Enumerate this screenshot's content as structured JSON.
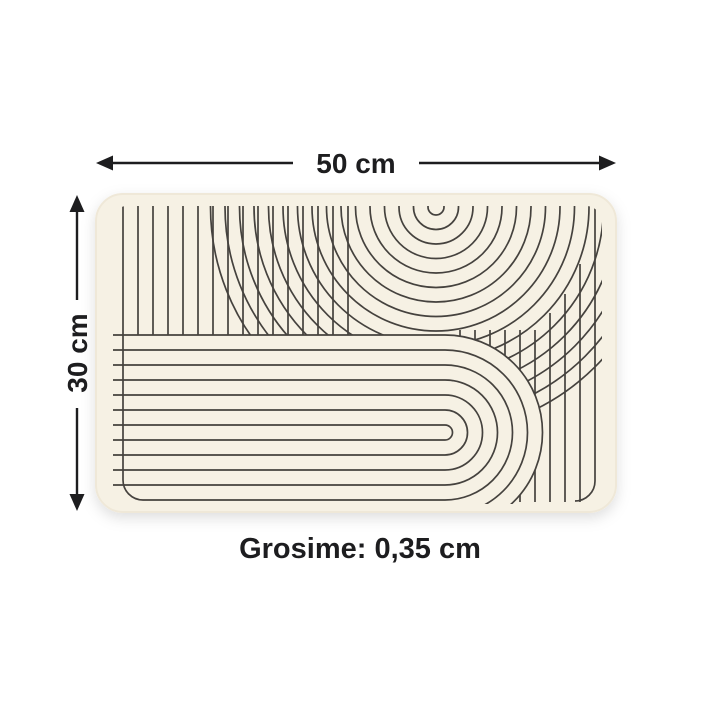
{
  "diagram": {
    "type": "product-dimension-diagram",
    "subject": "zen-pattern-mat",
    "width": {
      "label": "50 cm",
      "orientation": "horizontal",
      "position": "top"
    },
    "height": {
      "label": "30 cm",
      "orientation": "vertical",
      "position": "left"
    },
    "thickness": {
      "label": "Grosime: 0,35 cm",
      "position": "bottom"
    }
  },
  "colors": {
    "mat-fill": "#f6f1e4",
    "mat-edge": "#efe8d8",
    "pattern-line": "#45423e",
    "annotation": "#1d1d1f",
    "page-bg": "#ffffff"
  }
}
